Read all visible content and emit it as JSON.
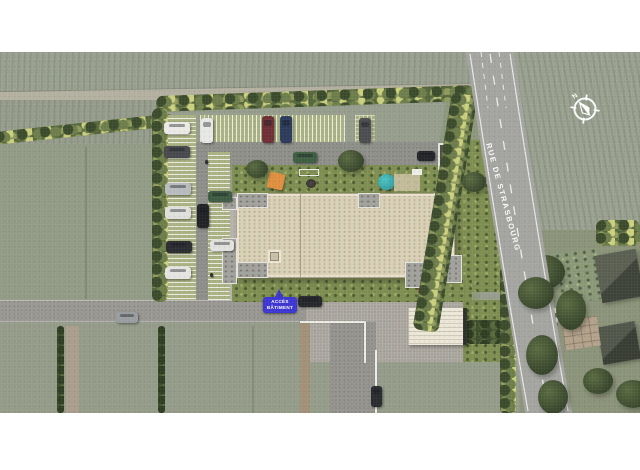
{
  "meta": {
    "scene": "aerial-site-plan-of-residential-building"
  },
  "labels": {
    "street_name": "RUE DE STRASBOURG",
    "access_badge_line1": "ACCÈS",
    "access_badge_line2": "BÂTIMENT",
    "compass_north": "N"
  },
  "colors": {
    "badge_blue": "#3d35d2",
    "badge_text": "#ffffff",
    "street_text": "#ffffff",
    "compass": "#ffffff",
    "road_gray": "#a4a4a0",
    "building_roof_beige": "#d9d0b6",
    "lawn_green": "#7e8e51",
    "canopy_orange": "#df8f3e",
    "parasol_teal": "#35b3b5",
    "rug_red": "#9c3a38",
    "letterbox": "#ffffff"
  }
}
